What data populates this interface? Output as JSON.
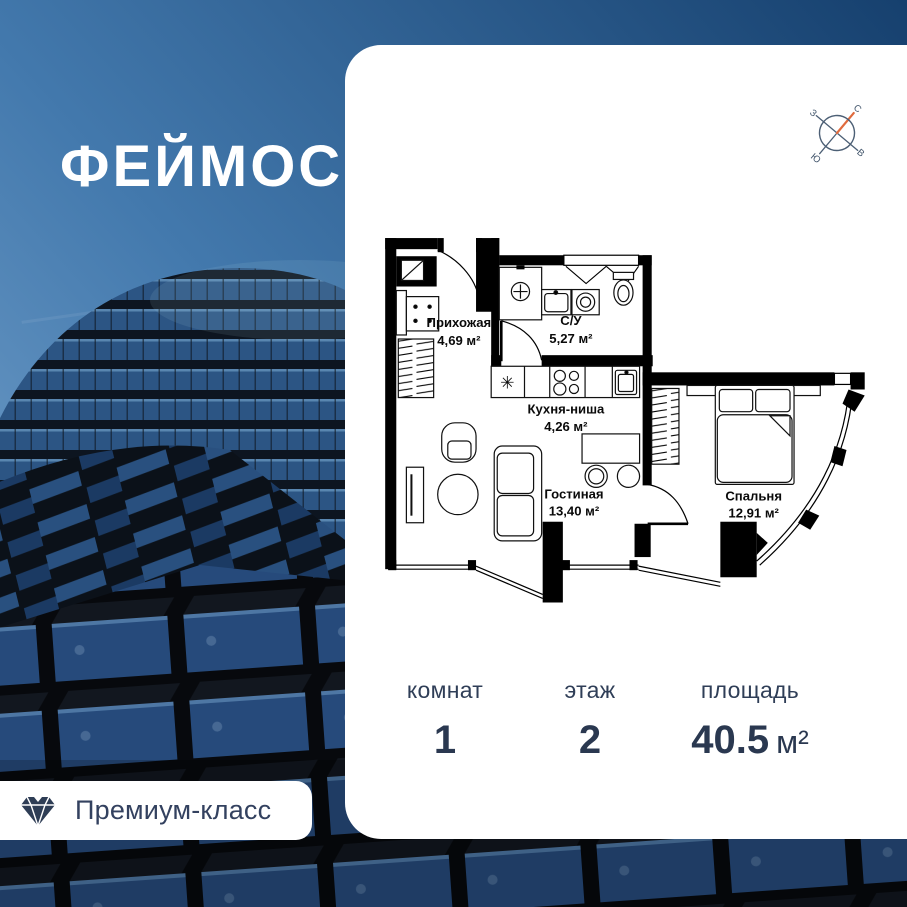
{
  "logo": {
    "text": "ФЕЙМОС"
  },
  "badge": {
    "label": "Премиум-класс",
    "icon": "diamond-icon"
  },
  "compass": {
    "north": "С",
    "south": "Ю",
    "west": "З",
    "east": "В",
    "accent_color": "#e06b3e",
    "line_color": "#4c5f75"
  },
  "floor_plan": {
    "kitchen_sink_symbol": "✳",
    "rooms": [
      {
        "name": "Прихожая",
        "area": "4,69 м²"
      },
      {
        "name": "С/У",
        "area": "5,27 м²"
      },
      {
        "name": "Кухня-ниша",
        "area": "4,26 м²"
      },
      {
        "name": "Гостиная",
        "area": "13,40 м²"
      },
      {
        "name": "Спальня",
        "area": "12,91 м²"
      }
    ]
  },
  "stats": [
    {
      "label": "комнат",
      "value": "1"
    },
    {
      "label": "этаж",
      "value": "2"
    },
    {
      "label": "площадь",
      "value": "40.5",
      "unit": "м²"
    }
  ],
  "colors": {
    "card_bg": "#ffffff",
    "text_primary": "#2a3850",
    "plan_line": "#000000",
    "sky_dark": "#16406e",
    "sky_light": "#6496c6"
  }
}
